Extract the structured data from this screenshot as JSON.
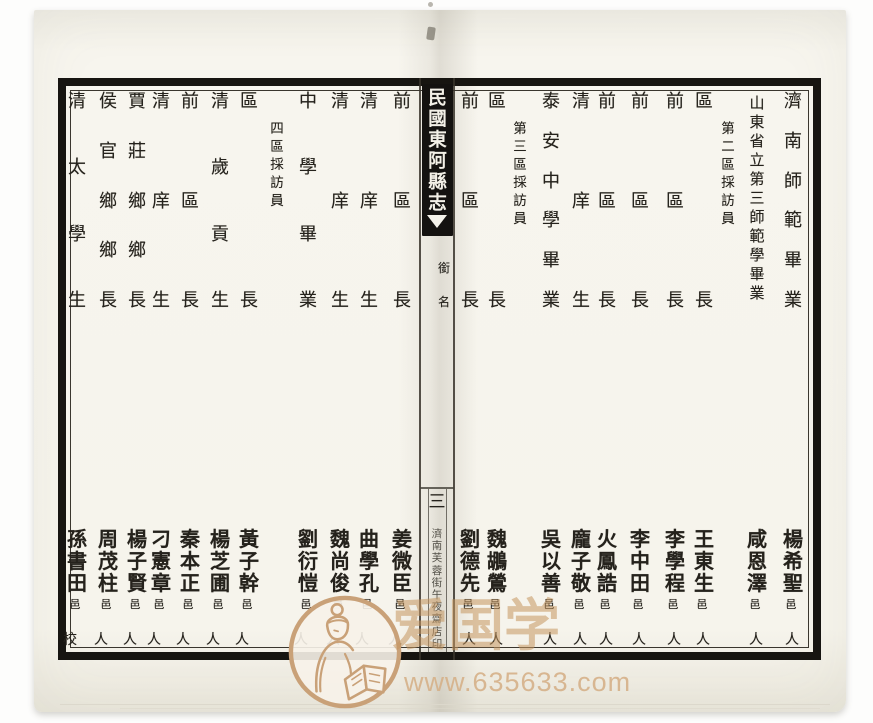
{
  "scan": {
    "spine": {
      "title": "民國東阿縣志",
      "section_label": "銜名",
      "page_number": "三",
      "printer_colophon": "濟南芙蓉街午夜齋店印"
    },
    "right_page": {
      "columns": [
        {
          "x": 793,
          "role": "entry",
          "title": "濟南師範畢業",
          "name": "楊希聖",
          "native": "邑",
          "footer": "人"
        },
        {
          "x": 757,
          "role": "entry",
          "title": "山東省立第三師範學畢業",
          "name": "咸恩澤",
          "native": "邑",
          "footer": "人"
        },
        {
          "x": 728,
          "role": "section-header",
          "title": "第二區採訪員"
        },
        {
          "x": 704,
          "role": "entry",
          "title": "區長",
          "name": "王東生",
          "native": "邑",
          "footer": "人"
        },
        {
          "x": 675,
          "role": "entry",
          "title": "前區長",
          "name": "李學程",
          "native": "邑",
          "footer": "人"
        },
        {
          "x": 640,
          "role": "entry",
          "title": "前區長",
          "name": "李中田",
          "native": "邑",
          "footer": "人"
        },
        {
          "x": 607,
          "role": "entry",
          "title": "前區長",
          "name": "火鳳誥",
          "native": "邑",
          "footer": "人"
        },
        {
          "x": 581,
          "role": "entry",
          "title": "清庠生",
          "name": "龐子敬",
          "native": "邑",
          "footer": "人"
        },
        {
          "x": 551,
          "role": "entry",
          "title": "泰安中學畢業",
          "name": "吳以善",
          "native": "邑",
          "footer": "人"
        },
        {
          "x": 520,
          "role": "section-header",
          "title": "第三區採訪員"
        },
        {
          "x": 497,
          "role": "entry",
          "title": "區長",
          "name": "魏鶘鶯",
          "native": "邑",
          "footer": "人"
        },
        {
          "x": 470,
          "role": "entry",
          "title": "前區長",
          "name": "劉德先",
          "native": "邑",
          "footer": "人"
        }
      ]
    },
    "left_page": {
      "columns": [
        {
          "x": 402,
          "role": "entry",
          "title": "前區長",
          "name": "姜微臣",
          "native": "邑",
          "footer": "人"
        },
        {
          "x": 369,
          "role": "entry",
          "title": "清庠生",
          "name": "曲學孔",
          "native": "邑",
          "footer": "人"
        },
        {
          "x": 340,
          "role": "entry",
          "title": "清庠生",
          "name": "魏尚俊",
          "native": "邑",
          "footer": "人"
        },
        {
          "x": 308,
          "role": "entry",
          "title": "中學畢業",
          "name": "劉衍愷",
          "native": "邑",
          "footer": "人"
        },
        {
          "x": 277,
          "role": "section-header",
          "title": "四區採訪員"
        },
        {
          "x": 249,
          "role": "entry",
          "title": "區長",
          "name": "黃子幹",
          "native": "邑",
          "footer": "人"
        },
        {
          "x": 220,
          "role": "entry",
          "title": "清歲貢生",
          "name": "楊芝圃",
          "native": "邑",
          "footer": "人"
        },
        {
          "x": 190,
          "role": "entry",
          "title": "前區長",
          "name": "秦本正",
          "native": "邑",
          "footer": "人"
        },
        {
          "x": 161,
          "role": "entry",
          "title": "清庠生",
          "name": "刁憲章",
          "native": "邑",
          "footer": "人"
        },
        {
          "x": 137,
          "role": "entry",
          "title": "賈莊鄉鄉長",
          "name": "楊子賢",
          "native": "邑",
          "footer": "人"
        },
        {
          "x": 108,
          "role": "entry",
          "title": "侯官鄉鄉長",
          "name": "周茂柱",
          "native": "邑",
          "footer": "人"
        },
        {
          "x": 77,
          "role": "entry",
          "title": "清太學生",
          "name": "孫書田",
          "native": "邑",
          "footer": "校"
        }
      ]
    },
    "watermark": {
      "text": "爱国学",
      "url": "www.635633.com",
      "emblem": "scholar-reading-book-seal",
      "color": "#c89a66"
    }
  }
}
